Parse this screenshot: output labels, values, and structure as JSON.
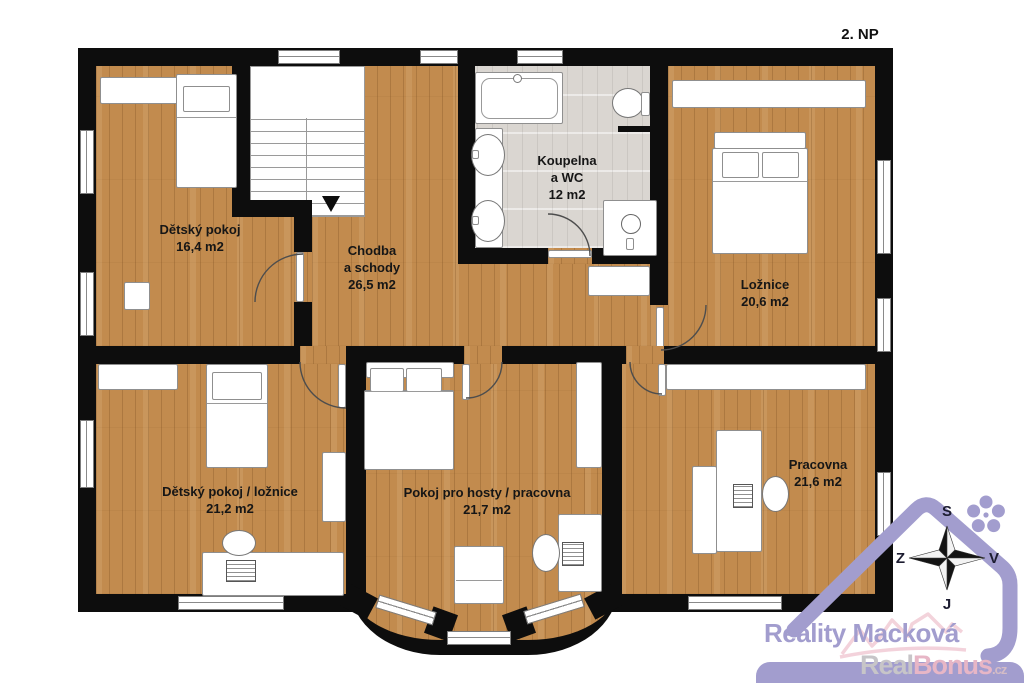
{
  "floor_label": "2. NP",
  "rooms": [
    {
      "name": "Dětský pokoj",
      "area": "16,4 m2"
    },
    {
      "name": "Chodba\na schody",
      "area": "26,5 m2"
    },
    {
      "name": "Koupelna\na WC",
      "area": "12 m2"
    },
    {
      "name": "Ložnice",
      "area": "20,6 m2"
    },
    {
      "name": "Dětský pokoj / ložnice",
      "area": "21,2 m2"
    },
    {
      "name": "Pokoj pro hosty / pracovna",
      "area": "21,7 m2"
    },
    {
      "name": "Pracovna",
      "area": "21,6 m2"
    }
  ],
  "compass": {
    "north_label": "S",
    "east_label": "V",
    "south_label": "J",
    "west_label": "Z"
  },
  "branding": {
    "agency_name": "Reality Macková",
    "watermark": {
      "part1": "Real",
      "part2": "Bonus",
      "tld": ".cz"
    }
  },
  "colors": {
    "accent_lavender": "#a29dce",
    "wall_black": "#0d0d0d",
    "wood_floor": "#c28b4e",
    "tile_floor": "#dad6d1",
    "watermark_gray": "#c7c5c8",
    "watermark_pink": "#e7b6c6"
  }
}
